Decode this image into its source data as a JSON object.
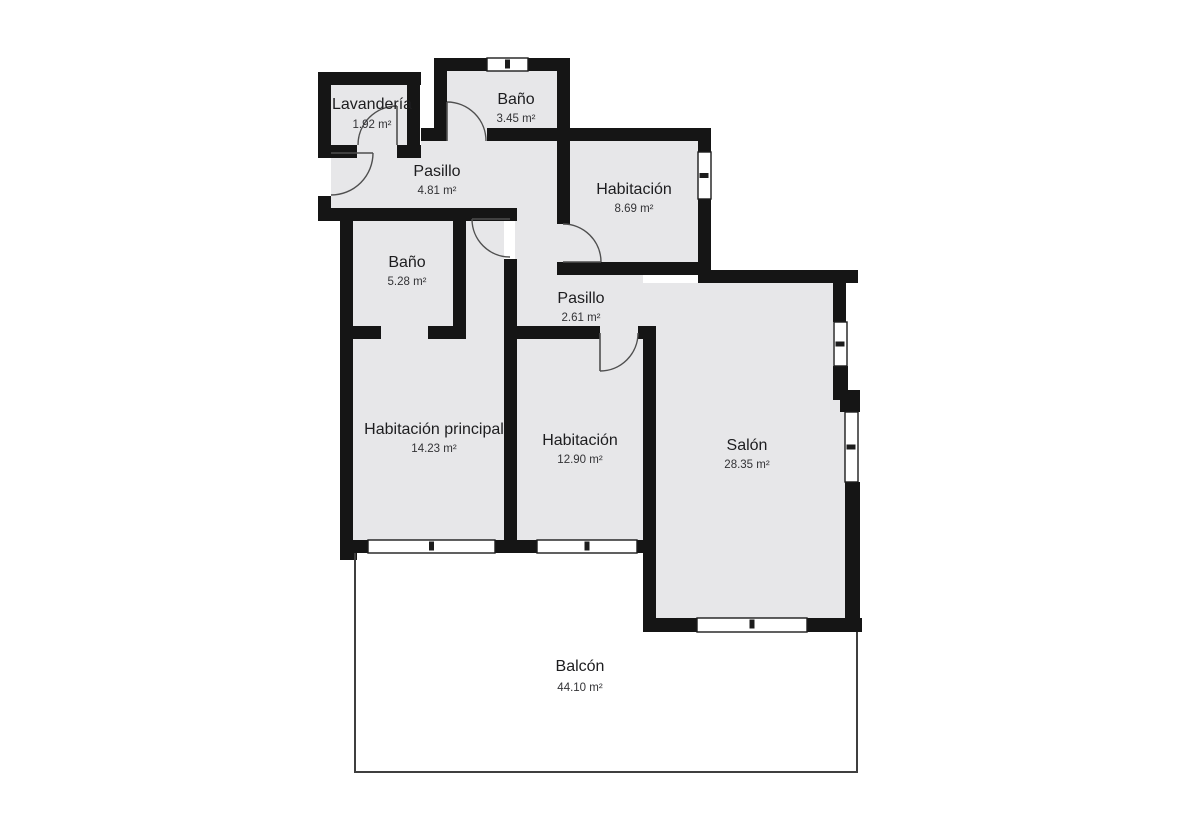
{
  "plan": {
    "colors": {
      "background": "#ffffff",
      "wall": "#151515",
      "floor": "#e7e7e9",
      "door_line": "#4f4f4f",
      "window_line": "#1c1c1c",
      "balcony_line": "#3f3f3f"
    },
    "rooms": [
      {
        "id": "lavanderia",
        "name": "Lavandería",
        "area": "1.92 m²",
        "nx": 372,
        "ny": 109,
        "ax": 372,
        "ay": 128
      },
      {
        "id": "bano-1",
        "name": "Baño",
        "area": "3.45 m²",
        "nx": 516,
        "ny": 104,
        "ax": 516,
        "ay": 122
      },
      {
        "id": "pasillo-1",
        "name": "Pasillo",
        "area": "4.81 m²",
        "nx": 437,
        "ny": 176,
        "ax": 437,
        "ay": 194
      },
      {
        "id": "habitacion-1",
        "name": "Habitación",
        "area": "8.69 m²",
        "nx": 634,
        "ny": 194,
        "ax": 634,
        "ay": 212
      },
      {
        "id": "bano-2",
        "name": "Baño",
        "area": "5.28 m²",
        "nx": 407,
        "ny": 267,
        "ax": 407,
        "ay": 285
      },
      {
        "id": "pasillo-2",
        "name": "Pasillo",
        "area": "2.61 m²",
        "nx": 581,
        "ny": 303,
        "ax": 581,
        "ay": 321
      },
      {
        "id": "habitacion-principal",
        "name": "Habitación principal",
        "area": "14.23 m²",
        "nx": 434,
        "ny": 434,
        "ax": 434,
        "ay": 452
      },
      {
        "id": "habitacion-2",
        "name": "Habitación",
        "area": "12.90 m²",
        "nx": 580,
        "ny": 445,
        "ax": 580,
        "ay": 463
      },
      {
        "id": "salon",
        "name": "Salón",
        "area": "28.35 m²",
        "nx": 747,
        "ny": 450,
        "ax": 747,
        "ay": 468
      },
      {
        "id": "balcon",
        "name": "Balcón",
        "area": "44.10 m²",
        "nx": 580,
        "ny": 671,
        "ax": 580,
        "ay": 691
      }
    ],
    "floors": [
      [
        331,
        85,
        76,
        60
      ],
      [
        447,
        71,
        110,
        57
      ],
      [
        331,
        158,
        90,
        50
      ],
      [
        421,
        141,
        136,
        67
      ],
      [
        515,
        208,
        42,
        67
      ],
      [
        357,
        145,
        40,
        13
      ],
      [
        447,
        128,
        40,
        13
      ],
      [
        557,
        224,
        13,
        38
      ],
      [
        466,
        221,
        38,
        118
      ],
      [
        353,
        221,
        100,
        105
      ],
      [
        381,
        326,
        47,
        13
      ],
      [
        570,
        141,
        128,
        121
      ],
      [
        517,
        262,
        126,
        64
      ],
      [
        643,
        283,
        13,
        43
      ],
      [
        353,
        339,
        151,
        201
      ],
      [
        517,
        339,
        126,
        201
      ],
      [
        600,
        326,
        38,
        13
      ],
      [
        656,
        283,
        177,
        335
      ],
      [
        833,
        400,
        12,
        218
      ]
    ],
    "walls": [
      [
        318,
        72,
        103,
        13
      ],
      [
        318,
        72,
        13,
        81
      ],
      [
        407,
        72,
        13,
        86
      ],
      [
        318,
        145,
        39,
        13
      ],
      [
        397,
        145,
        24,
        13
      ],
      [
        318,
        196,
        13,
        14
      ],
      [
        318,
        208,
        40,
        13
      ],
      [
        340,
        208,
        13,
        345
      ],
      [
        434,
        58,
        13,
        83
      ],
      [
        421,
        128,
        26,
        13
      ],
      [
        434,
        58,
        53,
        13
      ],
      [
        528,
        58,
        42,
        13
      ],
      [
        557,
        58,
        13,
        166
      ],
      [
        487,
        128,
        70,
        13
      ],
      [
        557,
        128,
        154,
        13
      ],
      [
        698,
        128,
        13,
        24
      ],
      [
        698,
        199,
        13,
        76
      ],
      [
        557,
        262,
        154,
        13
      ],
      [
        331,
        208,
        186,
        13
      ],
      [
        453,
        208,
        13,
        125
      ],
      [
        428,
        326,
        38,
        13
      ],
      [
        504,
        259,
        13,
        80
      ],
      [
        353,
        326,
        28,
        13
      ],
      [
        504,
        326,
        13,
        227
      ],
      [
        504,
        326,
        96,
        13
      ],
      [
        638,
        326,
        18,
        13
      ],
      [
        643,
        326,
        13,
        306
      ],
      [
        698,
        270,
        160,
        13
      ],
      [
        833,
        270,
        13,
        52
      ],
      [
        833,
        366,
        15,
        34
      ],
      [
        840,
        390,
        20,
        22
      ],
      [
        845,
        482,
        15,
        150
      ],
      [
        643,
        618,
        54,
        14
      ],
      [
        807,
        618,
        55,
        14
      ],
      [
        340,
        540,
        17,
        20
      ],
      [
        340,
        540,
        28,
        13
      ],
      [
        495,
        540,
        42,
        13
      ],
      [
        637,
        540,
        19,
        13
      ]
    ],
    "windows": [
      {
        "x": 487,
        "y": 58,
        "w": 41,
        "h": 13,
        "o": "h"
      },
      {
        "x": 698,
        "y": 152,
        "w": 13,
        "h": 47,
        "o": "v"
      },
      {
        "x": 834,
        "y": 322,
        "w": 13,
        "h": 44,
        "o": "v"
      },
      {
        "x": 845,
        "y": 412,
        "w": 13,
        "h": 70,
        "o": "v"
      },
      {
        "x": 697,
        "y": 618,
        "w": 110,
        "h": 14,
        "o": "h"
      },
      {
        "x": 368,
        "y": 540,
        "w": 127,
        "h": 13,
        "o": "h"
      },
      {
        "x": 537,
        "y": 540,
        "w": 100,
        "h": 13,
        "o": "h"
      }
    ],
    "doors": [
      {
        "x1": 358,
        "y1": 145,
        "x2": 397,
        "y2": 106,
        "r": 39,
        "sweep": 1,
        "lx1": 397,
        "ly1": 145,
        "lx2": 397,
        "ly2": 106
      },
      {
        "x1": 373,
        "y1": 153,
        "x2": 331,
        "y2": 195,
        "r": 42,
        "sweep": 1,
        "lx1": 331,
        "ly1": 153,
        "lx2": 373,
        "ly2": 153
      },
      {
        "x1": 447,
        "y1": 102,
        "x2": 486,
        "y2": 141,
        "r": 39,
        "sweep": 1,
        "lx1": 447,
        "ly1": 141,
        "lx2": 447,
        "ly2": 102
      },
      {
        "x1": 472,
        "y1": 219,
        "x2": 510,
        "y2": 257,
        "r": 38,
        "sweep": 0,
        "lx1": 472,
        "ly1": 219,
        "lx2": 510,
        "ly2": 219
      },
      {
        "x1": 563,
        "y1": 224,
        "x2": 601,
        "y2": 262,
        "r": 38,
        "sweep": 1,
        "lx1": 563,
        "ly1": 262,
        "lx2": 601,
        "ly2": 262
      },
      {
        "x1": 638,
        "y1": 333,
        "x2": 600,
        "y2": 371,
        "r": 38,
        "sweep": 1,
        "lx1": 600,
        "ly1": 333,
        "lx2": 600,
        "ly2": 371
      }
    ],
    "balcony_outline": "355,553 355,772 857,772 857,632"
  }
}
